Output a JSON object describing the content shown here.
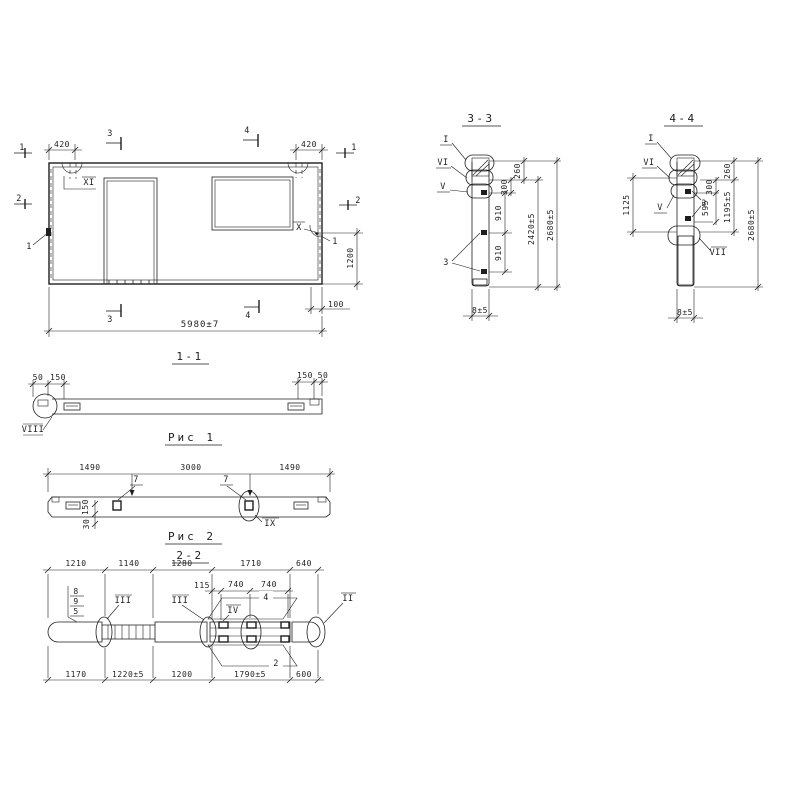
{
  "palette": {
    "ink": "#1e1e1e",
    "paper": "#ffffff"
  },
  "elevation": {
    "dim_420": "420",
    "dim_total": "5980±7",
    "dim_1200": "1200",
    "dim_100": "100",
    "mark_1": "1",
    "mark_2": "2",
    "mark_3": "3",
    "mark_4": "4",
    "label_xi": "XI",
    "label_x": "X",
    "pos_1": "1"
  },
  "section_1_1": {
    "title": "1-1",
    "dim_50": "50",
    "dim_150": "150",
    "label_viii": "VIII",
    "caption": "Рис 1"
  },
  "fig2": {
    "dim_1490": "1490",
    "dim_3000": "3000",
    "pos_7": "7",
    "dim_150": "150",
    "dim_30": "30",
    "label_ix": "IX",
    "caption": "Рис 2"
  },
  "section_2_2": {
    "title": "2-2",
    "top_dims": [
      "1210",
      "1140",
      "1280",
      "1710",
      "640"
    ],
    "mid_dims": [
      "115",
      "740",
      "740"
    ],
    "pos_stack": [
      "8",
      "9",
      "5"
    ],
    "label_iii": "III",
    "label_iv": "IV",
    "label_ii": "II",
    "pos_4": "4",
    "pos_2": "2",
    "bottom_dims": [
      "1170",
      "1220±5",
      "1200",
      "1790±5",
      "600"
    ]
  },
  "section_3_3": {
    "title": "3-3",
    "label_i": "I",
    "label_vi": "VI",
    "label_v": "V",
    "pos_3": "3",
    "d260": "260",
    "d300": "300",
    "d910": "910",
    "d2420": "2420±5",
    "d2680": "2680±5",
    "thickness": "8±5"
  },
  "section_4_4": {
    "title": "4-4",
    "label_i": "I",
    "label_vi": "VI",
    "label_v": "V",
    "pos_3": "3",
    "label_vii": "VII",
    "d1125": "1125",
    "d260": "260",
    "d300": "300",
    "d595": "595",
    "d1195": "1195±5",
    "d2680": "2680±5",
    "thickness": "8±5"
  }
}
